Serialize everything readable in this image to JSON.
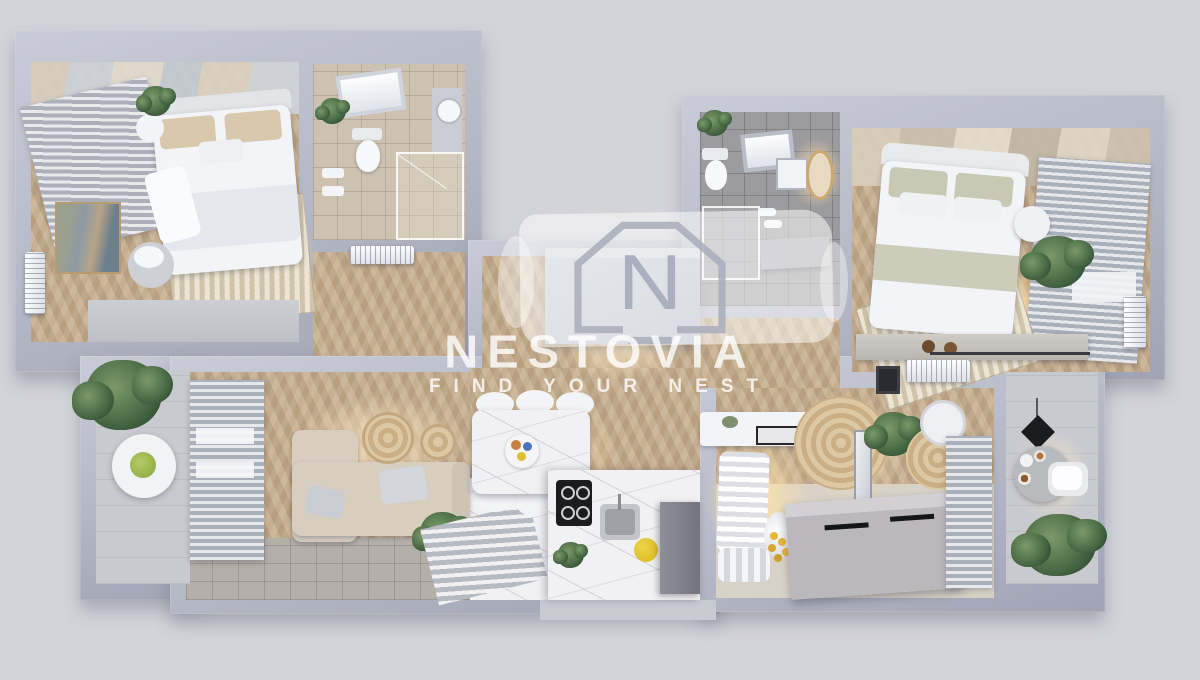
{
  "watermark": {
    "logo_letter": "N",
    "brand": "NESTOVIA",
    "tagline": "FIND YOUR NEST"
  },
  "palette": {
    "background": "#d3d4da",
    "wall": "#b4b7c5",
    "wall_light": "#c9ccd7",
    "wall_dark": "#a0a3b4",
    "wood": "#c7b091",
    "tile_beige": "#cdc2b0",
    "tile_gray": "#9c9b9e",
    "marble": "#f1f1f3",
    "cream": "#d8d2c6",
    "stone": "#b4afa9",
    "balcony": "#c9cad0",
    "sofa": "#d7cec0",
    "plant": "#45603f",
    "glow": "#ffe9c4",
    "accent_yellow": "#e0c02a",
    "accent_black": "#1b1c20",
    "watermark_text": "rgba(255,255,255,0.80)"
  }
}
